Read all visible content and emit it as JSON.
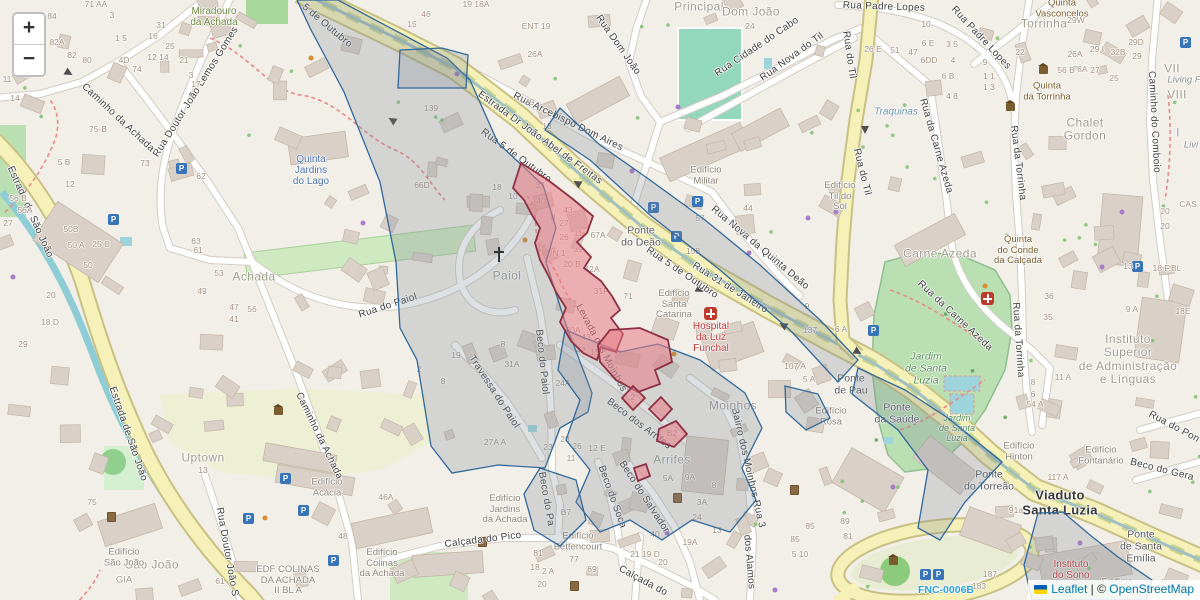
{
  "controls": {
    "zoom_in_label": "+",
    "zoom_out_label": "−"
  },
  "attribution": {
    "flag_icon": "ukraine-flag",
    "leaflet_link": "Leaflet",
    "separator": "|",
    "copyright_prefix": "©",
    "osm_link": "OpenStreetMap"
  },
  "colors": {
    "overlay_blue_stroke": "#31689a",
    "overlay_gray_fill": "rgba(125,135,148,0.25)",
    "zone_red_stroke": "#8e3044",
    "zone_red_fill": "rgba(232,122,132,0.55)",
    "link_blue": "#0078A8",
    "road_primary": "#f5f1b8",
    "park_green": "#b9dfb2",
    "water_teal": "#8fcdd6"
  },
  "labels": [
    {
      "t": "5 de Outubro",
      "x": 327,
      "y": 26,
      "r": 40,
      "c": "road"
    },
    {
      "t": "Rua 5 de Outubro",
      "x": 516,
      "y": 156,
      "r": 36,
      "c": "road"
    },
    {
      "t": "Estrada Dr João Abel de Freitas",
      "x": 540,
      "y": 138,
      "r": 36,
      "c": "road"
    },
    {
      "t": "Rua Arcebispo Dom Aires",
      "x": 568,
      "y": 122,
      "r": 26,
      "c": "road"
    },
    {
      "t": "Rua 5 de Outubro",
      "x": 682,
      "y": 273,
      "r": 34,
      "c": "road"
    },
    {
      "t": "Rua 31 de Janeiro",
      "x": 730,
      "y": 288,
      "r": 32,
      "c": "road"
    },
    {
      "t": "Rua Nova da Quinta Deão",
      "x": 760,
      "y": 248,
      "r": 40,
      "c": "road"
    },
    {
      "t": "Rua Dom João",
      "x": 618,
      "y": 45,
      "r": 55,
      "c": "road"
    },
    {
      "t": "Rua Cidade do Cabo",
      "x": 757,
      "y": 47,
      "r": -34,
      "c": "road"
    },
    {
      "t": "Rua Nova do Til",
      "x": 792,
      "y": 57,
      "r": -36,
      "c": "road"
    },
    {
      "t": "Rua do Til",
      "x": 849,
      "y": 55,
      "r": 82,
      "c": "road"
    },
    {
      "t": "Rua do Til",
      "x": 862,
      "y": 172,
      "r": 76,
      "c": "road"
    },
    {
      "t": "Rua Padre Lopes",
      "x": 884,
      "y": 7,
      "r": 2,
      "c": "road"
    },
    {
      "t": "Rua Padre Lopes",
      "x": 981,
      "y": 38,
      "r": 47,
      "c": "road"
    },
    {
      "t": "Rua da Carne Azeda",
      "x": 936,
      "y": 146,
      "r": 74,
      "c": "road"
    },
    {
      "t": "Rua da Carne Azeda",
      "x": 955,
      "y": 316,
      "r": 43,
      "c": "road"
    },
    {
      "t": "Rua da Torrinha",
      "x": 1018,
      "y": 163,
      "r": 83,
      "c": "road"
    },
    {
      "t": "Rua da Torrinha",
      "x": 1018,
      "y": 340,
      "r": 86,
      "c": "road"
    },
    {
      "t": "Caminho do Comboio",
      "x": 1154,
      "y": 122,
      "r": 87,
      "c": "road"
    },
    {
      "t": "Caminho da Achada",
      "x": 118,
      "y": 118,
      "r": 43,
      "c": "road"
    },
    {
      "t": "Caminho da Achada",
      "x": 319,
      "y": 436,
      "r": 64,
      "c": "road"
    },
    {
      "t": "Estrada de São João",
      "x": 30,
      "y": 212,
      "r": 66,
      "c": "road"
    },
    {
      "t": "Estrada de São João",
      "x": 128,
      "y": 434,
      "r": 71,
      "c": "road"
    },
    {
      "t": "Rua Doutor João Lemos Gomes",
      "x": 196,
      "y": 92,
      "r": -58,
      "c": "road"
    },
    {
      "t": "Rua Doutor João S",
      "x": 227,
      "y": 552,
      "r": 80,
      "c": "road"
    },
    {
      "t": "Rua do Paiol",
      "x": 388,
      "y": 306,
      "r": -18,
      "c": "road"
    },
    {
      "t": "Beco do Paiol",
      "x": 542,
      "y": 362,
      "r": 84,
      "c": "road"
    },
    {
      "t": "Travessa do Paiol",
      "x": 494,
      "y": 392,
      "r": 57,
      "c": "road"
    },
    {
      "t": "Beco dos Arrifes",
      "x": 639,
      "y": 424,
      "r": 37,
      "c": "road"
    },
    {
      "t": "Beco do Soca",
      "x": 612,
      "y": 497,
      "r": 70,
      "c": "road"
    },
    {
      "t": "Beco do Salvador",
      "x": 644,
      "y": 497,
      "r": 57,
      "c": "road"
    },
    {
      "t": "Beco do Pa",
      "x": 546,
      "y": 499,
      "r": 80,
      "c": "road"
    },
    {
      "t": "Calçada do Pico",
      "x": 483,
      "y": 540,
      "r": -7,
      "c": "road"
    },
    {
      "t": "Calçada do",
      "x": 643,
      "y": 581,
      "r": 28,
      "c": "road"
    },
    {
      "t": "dos Alamos",
      "x": 749,
      "y": 562,
      "r": 85,
      "c": "road"
    },
    {
      "t": "Bairro dos Moinhos Rua 3",
      "x": 748,
      "y": 468,
      "r": 77,
      "c": "road"
    },
    {
      "t": "Levada dos Moinhos",
      "x": 601,
      "y": 348,
      "r": 62,
      "c": "road"
    },
    {
      "t": "Beco do Gera",
      "x": 1162,
      "y": 470,
      "r": 14,
      "c": "road"
    },
    {
      "t": "Rua do Pon",
      "x": 1174,
      "y": 427,
      "r": 28,
      "c": "road"
    },
    {
      "t": "Viaduto\nSanta Luzia",
      "x": 1060,
      "y": 503,
      "c": "road-big"
    },
    {
      "t": "Ponte\ndo Deão",
      "x": 641,
      "y": 237,
      "c": "bridge"
    },
    {
      "t": "Ponte\nde Pau",
      "x": 851,
      "y": 385,
      "c": "bridge"
    },
    {
      "t": "Ponte\nda Saúde",
      "x": 897,
      "y": 414,
      "c": "bridge"
    },
    {
      "t": "Ponte\ndo Torreão",
      "x": 989,
      "y": 481,
      "c": "bridge"
    },
    {
      "t": "Ponte\nde Santa\nEmília",
      "x": 1141,
      "y": 547,
      "c": "bridge"
    },
    {
      "t": "Principal",
      "x": 699,
      "y": 7,
      "c": "area"
    },
    {
      "t": "Dom João",
      "x": 751,
      "y": 12,
      "c": "area"
    },
    {
      "t": "Achada",
      "x": 254,
      "y": 277,
      "c": "area"
    },
    {
      "t": "Moinhos",
      "x": 733,
      "y": 406,
      "c": "area"
    },
    {
      "t": "Arrifes",
      "x": 672,
      "y": 460,
      "c": "area"
    },
    {
      "t": "Carne Azeda",
      "x": 940,
      "y": 254,
      "c": "area"
    },
    {
      "t": "Uptown",
      "x": 203,
      "y": 458,
      "c": "area"
    },
    {
      "t": "Paiol",
      "x": 507,
      "y": 276,
      "c": "area"
    },
    {
      "t": "São João",
      "x": 152,
      "y": 565,
      "c": "area"
    },
    {
      "t": "GIA",
      "x": 124,
      "y": 581,
      "c": "area-sm"
    },
    {
      "t": "Torrinha",
      "x": 1044,
      "y": 24,
      "c": "area"
    },
    {
      "t": "Chalet\nGordon",
      "x": 1085,
      "y": 130,
      "c": "area"
    },
    {
      "t": "Instituto\nSuperior\nde Administração\ne Línguas",
      "x": 1128,
      "y": 360,
      "c": "area"
    },
    {
      "t": "Quinta\nJardins\ndo Lago",
      "x": 311,
      "y": 171,
      "c": "poi-blue"
    },
    {
      "t": "Traquinas",
      "x": 896,
      "y": 112,
      "c": "poi-italic-blue"
    },
    {
      "t": "Miradouro\nda Achada",
      "x": 214,
      "y": 17,
      "c": "poi-green"
    },
    {
      "t": "Quinta\nVasconcelos",
      "x": 1062,
      "y": 9,
      "c": "poi-brown"
    },
    {
      "t": "Quinta\nda Torrinha",
      "x": 1047,
      "y": 92,
      "c": "poi-brown"
    },
    {
      "t": "Quinta\ndo Conde\nda Calçada",
      "x": 1018,
      "y": 251,
      "c": "poi-brown"
    },
    {
      "t": "Hospital\nda Luz\nFunchal",
      "x": 711,
      "y": 338,
      "c": "poi-red"
    },
    {
      "t": "Instituto\ndo Sono",
      "x": 1071,
      "y": 570,
      "c": "poi-red"
    },
    {
      "t": "Jardim\nde Santa\nLuzia",
      "x": 926,
      "y": 369,
      "c": "park"
    },
    {
      "t": "Jardim\nde Santa\nLuzia",
      "x": 957,
      "y": 428,
      "c": "park-sm"
    },
    {
      "t": "Edifício\nMilitar",
      "x": 706,
      "y": 176,
      "c": "bldg"
    },
    {
      "t": "Edifício\nSanta\nCatarina",
      "x": 674,
      "y": 305,
      "c": "bldg"
    },
    {
      "t": "Edifício\nTil do\nSol",
      "x": 840,
      "y": 197,
      "c": "bldg"
    },
    {
      "t": "Edifício\nRosa",
      "x": 831,
      "y": 417,
      "c": "bldg"
    },
    {
      "t": "Edifício\nHinton",
      "x": 1019,
      "y": 452,
      "c": "bldg"
    },
    {
      "t": "Edifício\nFontanário",
      "x": 1101,
      "y": 456,
      "c": "bldg"
    },
    {
      "t": "Edifício\nAcácia",
      "x": 327,
      "y": 488,
      "c": "bldg"
    },
    {
      "t": "Edifício\nSão João",
      "x": 124,
      "y": 558,
      "c": "bldg"
    },
    {
      "t": "EDF COLINAS\nDA ACHADA\nII BL A",
      "x": 288,
      "y": 581,
      "c": "bldg"
    },
    {
      "t": "Edifício\nColinas\nda Achada",
      "x": 382,
      "y": 564,
      "c": "bldg"
    },
    {
      "t": "Edifício\nJardins\nda Achada",
      "x": 505,
      "y": 510,
      "c": "bldg"
    },
    {
      "t": "Edifício\nBettencourt",
      "x": 578,
      "y": 542,
      "c": "bldg"
    },
    {
      "t": "Edifício",
      "x": 1117,
      "y": 583,
      "c": "bldg"
    },
    {
      "t": "VII",
      "x": 1172,
      "y": 69,
      "c": "area"
    },
    {
      "t": "Living F",
      "x": 1184,
      "y": 81,
      "c": "italic-gray"
    },
    {
      "t": "VIII",
      "x": 1177,
      "y": 95,
      "c": "area"
    },
    {
      "t": "I",
      "x": 1178,
      "y": 133,
      "c": "area"
    },
    {
      "t": "Livi",
      "x": 1191,
      "y": 146,
      "c": "italic-gray"
    },
    {
      "t": "FNC-0006B",
      "x": 946,
      "y": 591,
      "c": "ref-blue"
    }
  ],
  "house_numbers": [
    [
      "71 AA",
      96,
      5
    ],
    [
      "84",
      52,
      17
    ],
    [
      "82A",
      57,
      43
    ],
    [
      "82",
      72,
      56
    ],
    [
      "80",
      87,
      61
    ],
    [
      "85 87",
      35,
      75
    ],
    [
      "11",
      7,
      80
    ],
    [
      "14",
      15,
      99
    ],
    [
      "3",
      112,
      16
    ],
    [
      "1 5",
      121,
      39
    ],
    [
      "31",
      161,
      26
    ],
    [
      "16",
      153,
      37
    ],
    [
      "25",
      170,
      47
    ],
    [
      "12 14",
      158,
      58
    ],
    [
      "21",
      184,
      61
    ],
    [
      "3",
      191,
      76
    ],
    [
      "17",
      196,
      85
    ],
    [
      "4D",
      124,
      61
    ],
    [
      "74",
      137,
      70
    ],
    [
      "75-B",
      98,
      130
    ],
    [
      "5 B",
      64,
      163
    ],
    [
      "12",
      70,
      185
    ],
    [
      "56 B",
      18,
      199
    ],
    [
      "56A",
      25,
      211
    ],
    [
      "27",
      8,
      224
    ],
    [
      "25 B",
      101,
      245
    ],
    [
      "73",
      145,
      164
    ],
    [
      "62",
      201,
      177
    ],
    [
      "63",
      196,
      242
    ],
    [
      "61",
      198,
      251
    ],
    [
      "53",
      219,
      274
    ],
    [
      "49",
      202,
      292
    ],
    [
      "47",
      234,
      308
    ],
    [
      "56",
      252,
      310
    ],
    [
      "41",
      234,
      320
    ],
    [
      "50B",
      71,
      230
    ],
    [
      "50 A",
      76,
      246
    ],
    [
      "50",
      88,
      266
    ],
    [
      "18 D",
      50,
      323
    ],
    [
      "20",
      51,
      296
    ],
    [
      "29",
      23,
      345
    ],
    [
      "46",
      426,
      15
    ],
    [
      "15",
      412,
      25
    ],
    [
      "19 18A",
      476,
      5
    ],
    [
      "ENT 19",
      536,
      27
    ],
    [
      "26A",
      535,
      55
    ],
    [
      "9",
      532,
      103
    ],
    [
      "13",
      547,
      127
    ],
    [
      "139",
      431,
      109
    ],
    [
      "66D",
      422,
      186
    ],
    [
      "18",
      497,
      188
    ],
    [
      "10",
      513,
      197
    ],
    [
      "37",
      540,
      186
    ],
    [
      "40",
      541,
      202
    ],
    [
      "43",
      568,
      211
    ],
    [
      "8",
      553,
      218
    ],
    [
      "27",
      564,
      224
    ],
    [
      "26",
      564,
      238
    ],
    [
      "11",
      578,
      234
    ],
    [
      "15",
      542,
      249
    ],
    [
      "N 1",
      559,
      254
    ],
    [
      "39",
      578,
      250
    ],
    [
      "20 B",
      572,
      265
    ],
    [
      "67A",
      598,
      236
    ],
    [
      "42A",
      592,
      270
    ],
    [
      "31F",
      601,
      292
    ],
    [
      "71",
      628,
      297
    ],
    [
      "30A",
      573,
      331
    ],
    [
      "43",
      586,
      338
    ],
    [
      "42",
      581,
      351
    ],
    [
      "15",
      595,
      353
    ],
    [
      "24A",
      563,
      384
    ],
    [
      "31A",
      512,
      365
    ],
    [
      "19",
      456,
      356
    ],
    [
      "8",
      503,
      345
    ],
    [
      "8",
      443,
      382
    ],
    [
      "27A A",
      495,
      443
    ],
    [
      "23",
      548,
      448
    ],
    [
      "28",
      565,
      440
    ],
    [
      "26",
      577,
      447
    ],
    [
      "12 E",
      597,
      449
    ],
    [
      "11",
      571,
      459
    ],
    [
      "158",
      693,
      252
    ],
    [
      "9",
      807,
      307
    ],
    [
      "137",
      810,
      331
    ],
    [
      "6 A",
      841,
      330
    ],
    [
      "107 A",
      795,
      367
    ],
    [
      "5 A",
      809,
      380
    ],
    [
      "24",
      750,
      27
    ],
    [
      "44",
      748,
      209
    ],
    [
      "57",
      700,
      219
    ],
    [
      "26A",
      1075,
      55
    ],
    [
      "76A",
      1080,
      70
    ],
    [
      "32B",
      1118,
      53
    ],
    [
      "29 I",
      1097,
      50
    ],
    [
      "29",
      1137,
      57
    ],
    [
      "29D",
      1136,
      43
    ],
    [
      "29W",
      1076,
      21
    ],
    [
      "26 E",
      873,
      50
    ],
    [
      "51",
      895,
      51
    ],
    [
      "47",
      913,
      53
    ],
    [
      "10",
      926,
      25
    ],
    [
      "6 E",
      928,
      44
    ],
    [
      "6DD",
      929,
      61
    ],
    [
      "4",
      953,
      61
    ],
    [
      "3 5",
      952,
      45
    ],
    [
      "9",
      985,
      63
    ],
    [
      "22",
      1020,
      53
    ],
    [
      "1 1",
      989,
      77
    ],
    [
      "1 3",
      989,
      88
    ],
    [
      "6 B",
      948,
      77
    ],
    [
      "4 8",
      952,
      97
    ],
    [
      "56 B",
      1066,
      71
    ],
    [
      "27",
      1095,
      71
    ],
    [
      "25",
      1114,
      79
    ],
    [
      "36",
      1049,
      297
    ],
    [
      "35",
      1048,
      318
    ],
    [
      "13",
      1128,
      267
    ],
    [
      "9 A",
      1132,
      310
    ],
    [
      "18E",
      1183,
      312
    ],
    [
      "18 F.BL",
      1167,
      269
    ],
    [
      "CAS",
      1188,
      205
    ],
    [
      "20",
      1165,
      212
    ],
    [
      "20",
      1165,
      227
    ],
    [
      "54 A",
      1035,
      405
    ],
    [
      "8",
      1033,
      383
    ],
    [
      "6",
      1033,
      395
    ],
    [
      "11 A",
      1063,
      378
    ],
    [
      "117 A",
      1058,
      478
    ],
    [
      "91a",
      1016,
      511
    ],
    [
      "187",
      990,
      575
    ],
    [
      "183",
      979,
      587
    ],
    [
      "19A",
      690,
      543
    ],
    [
      "13",
      717,
      531
    ],
    [
      "40",
      655,
      535
    ],
    [
      "21 19 D",
      645,
      555
    ],
    [
      "20",
      663,
      563
    ],
    [
      "85",
      810,
      527
    ],
    [
      "85",
      795,
      540
    ],
    [
      "5 10",
      800,
      555
    ],
    [
      "81",
      848,
      537
    ],
    [
      "89",
      845,
      522
    ],
    [
      "5A",
      668,
      479
    ],
    [
      "9A",
      690,
      478
    ],
    [
      "8",
      714,
      486
    ],
    [
      "3A",
      702,
      503
    ],
    [
      "24",
      697,
      518
    ],
    [
      "B7",
      566,
      513
    ],
    [
      "77",
      574,
      560
    ],
    [
      "81",
      538,
      554
    ],
    [
      "18",
      535,
      568
    ],
    [
      "2 A",
      548,
      572
    ],
    [
      "20",
      542,
      585
    ],
    [
      "69",
      592,
      570
    ],
    [
      "13",
      203,
      471
    ],
    [
      "61",
      220,
      582
    ],
    [
      "75",
      92,
      503
    ],
    [
      "48",
      343,
      537
    ],
    [
      "46A",
      386,
      498
    ],
    [
      "2",
      419,
      370
    ],
    [
      "B2",
      672,
      434
    ],
    [
      "2",
      633,
      398
    ]
  ],
  "icons": {
    "parking": [
      [
        181,
        168
      ],
      [
        113,
        219
      ],
      [
        697,
        201
      ],
      [
        676,
        236
      ],
      [
        1137,
        266
      ],
      [
        285,
        478
      ],
      [
        303,
        510
      ],
      [
        333,
        560
      ],
      [
        248,
        518
      ],
      [
        1185,
        42
      ],
      [
        938,
        574
      ],
      [
        925,
        574
      ],
      [
        873,
        330
      ],
      [
        653,
        207
      ]
    ],
    "hospital": [
      [
        710,
        313
      ],
      [
        987,
        298
      ]
    ],
    "church": [
      [
        499,
        255
      ]
    ],
    "monument": [
      [
        1043,
        70
      ],
      [
        1010,
        107
      ],
      [
        893,
        561
      ],
      [
        278,
        411
      ]
    ],
    "waste_bin": [
      [
        676,
        497
      ],
      [
        793,
        489
      ],
      [
        573,
        585
      ],
      [
        110,
        516
      ],
      [
        481,
        541
      ]
    ],
    "oneway_arrows": [
      [
        392,
        120,
        212
      ],
      [
        577,
        183,
        210
      ],
      [
        700,
        290,
        30
      ],
      [
        783,
        325,
        210
      ],
      [
        858,
        352,
        30
      ],
      [
        69,
        73,
        30
      ],
      [
        865,
        130,
        90
      ]
    ]
  }
}
